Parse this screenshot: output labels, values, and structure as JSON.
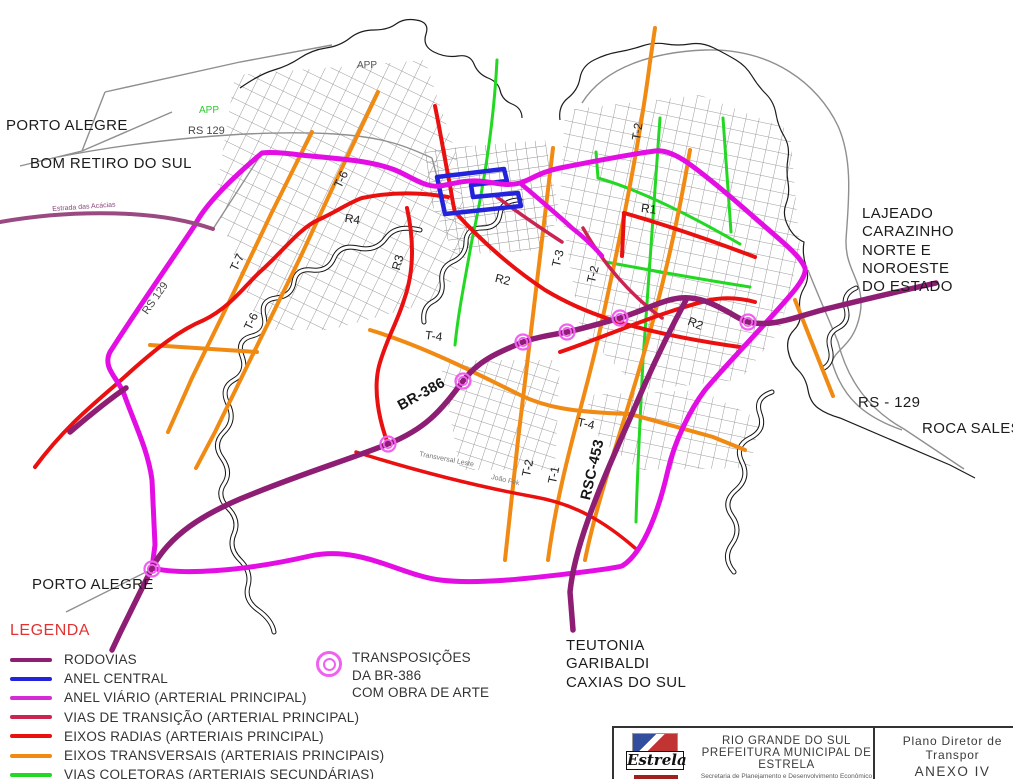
{
  "labels": {
    "porto_alegre_top": "PORTO ALEGRE",
    "bom_retiro": "BOM RETIRO DO SUL",
    "lajeado_block": "LAJEADO\nCARAZINHO\nNORTE E NOROESTE\nDO ESTADO",
    "rs129_right": "RS - 129",
    "roca_sales": "ROCA SALES",
    "porto_alegre_bottom": "PORTO ALEGRE",
    "teutonia_block": "TEUTONIA\nGARIBALDI\nCAXIAS DO SUL",
    "rs129_top": "RS 129",
    "rs129_left": "RS 129",
    "app_gray": "APP",
    "app_green": "APP",
    "estrada_acacias": "Estrada das Acácias",
    "br386": "BR-386",
    "rsc453": "RSC-453",
    "transversal_leste": "Transversal Leste",
    "joao_fek": "João Fek",
    "t7": "T-7",
    "t6": "T-6",
    "t6b": "T-6",
    "t4": "T-4",
    "t4b": "T-4",
    "t3": "T-3",
    "t2": "T-2",
    "t2b": "T-2",
    "t2c": "T-2",
    "t1": "T-1",
    "r1": "R1",
    "r2": "R2",
    "r2b": "R2",
    "r3": "R3",
    "r4": "R4"
  },
  "legend": {
    "title": "LEGENDA",
    "title_color": "#e23333",
    "items": [
      {
        "label": "RODOVIAS",
        "color": "#8e1d74"
      },
      {
        "label": "ANEL CENTRAL",
        "color": "#2323dc"
      },
      {
        "label": "ANEL VIÁRIO (ARTERIAL PRINCIPAL)",
        "color": "#d42bd4"
      },
      {
        "label": "VIAS DE TRANSIÇÃO (ARTERIAL PRINCIPAL)",
        "color": "#cc2450"
      },
      {
        "label": "EIXOS  RADIAS (ARTERIAIS PRINCIPAL)",
        "color": "#ea1010"
      },
      {
        "label": "EIXOS TRANSVERSAIS  (ARTERIAIS PRINCIPAIS)",
        "color": "#f08a12"
      },
      {
        "label": "VIAS  COLETORAS (ARTERIAIS SECUNDÁRIAS)",
        "color": "#22d822"
      }
    ],
    "transposition": {
      "text": "TRANSPOSIÇÕES\nDA BR-386\nCOM OBRA DE ARTE",
      "symbol_color": "#f061f0"
    }
  },
  "title_block": {
    "logo_text": "Estrela",
    "state": "RIO GRANDE DO SUL",
    "municipality": "PREFEITURA MUNICIPAL DE ESTRELA",
    "secretariat": "Secretaria de Planejamento e Desenvolvimento Econômico",
    "plan_title": "Plano Diretor de Transpor",
    "annex": "ANEXO IV",
    "subtitle": "REDE ESTRUTURAL MOBIL"
  },
  "colors": {
    "rodovia": "#8e1d74",
    "estrada_acacias": "#9a4a80",
    "anel_central": "#2323dc",
    "anel_viario": "#e30ee3",
    "transicao": "#cc2450",
    "radial": "#ea1010",
    "transversal": "#f08a12",
    "coletora": "#22d822",
    "transposicao": "#f061f0",
    "boundary": "#1c1c1c",
    "street": "#8f8f8f"
  }
}
